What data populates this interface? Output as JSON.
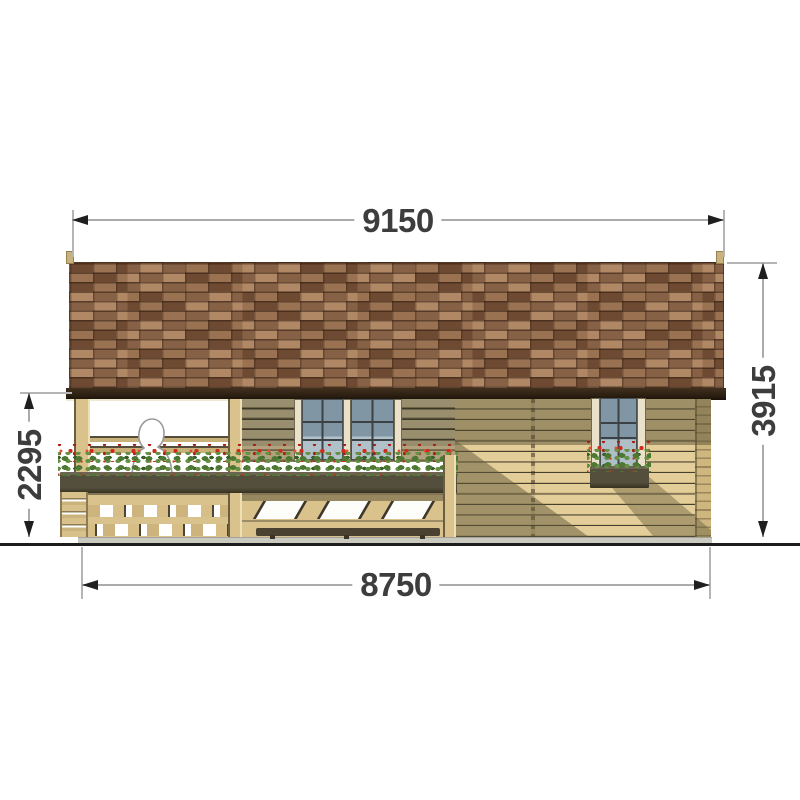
{
  "drawing": {
    "type": "house front elevation",
    "dimensions": {
      "roof_width": "9150",
      "overall_height": "3915",
      "porch_height": "2295",
      "base_width": "8750"
    },
    "colors": {
      "roof_shingle": "#8a6143",
      "fascia": "#2a1d10",
      "wall_tan": "#e3cd98",
      "wall_shadow_olive": "#6d6448",
      "planter": "#544e3d",
      "flower_red": "#cf2a1c",
      "leaf_green": "#4d7733",
      "glass_blue": "#8196a5",
      "window_trim": "#e9e1ca",
      "dimension_text": "#3d3d3d",
      "dimension_line": "#ababab",
      "ground": "#1d1d1d"
    }
  }
}
